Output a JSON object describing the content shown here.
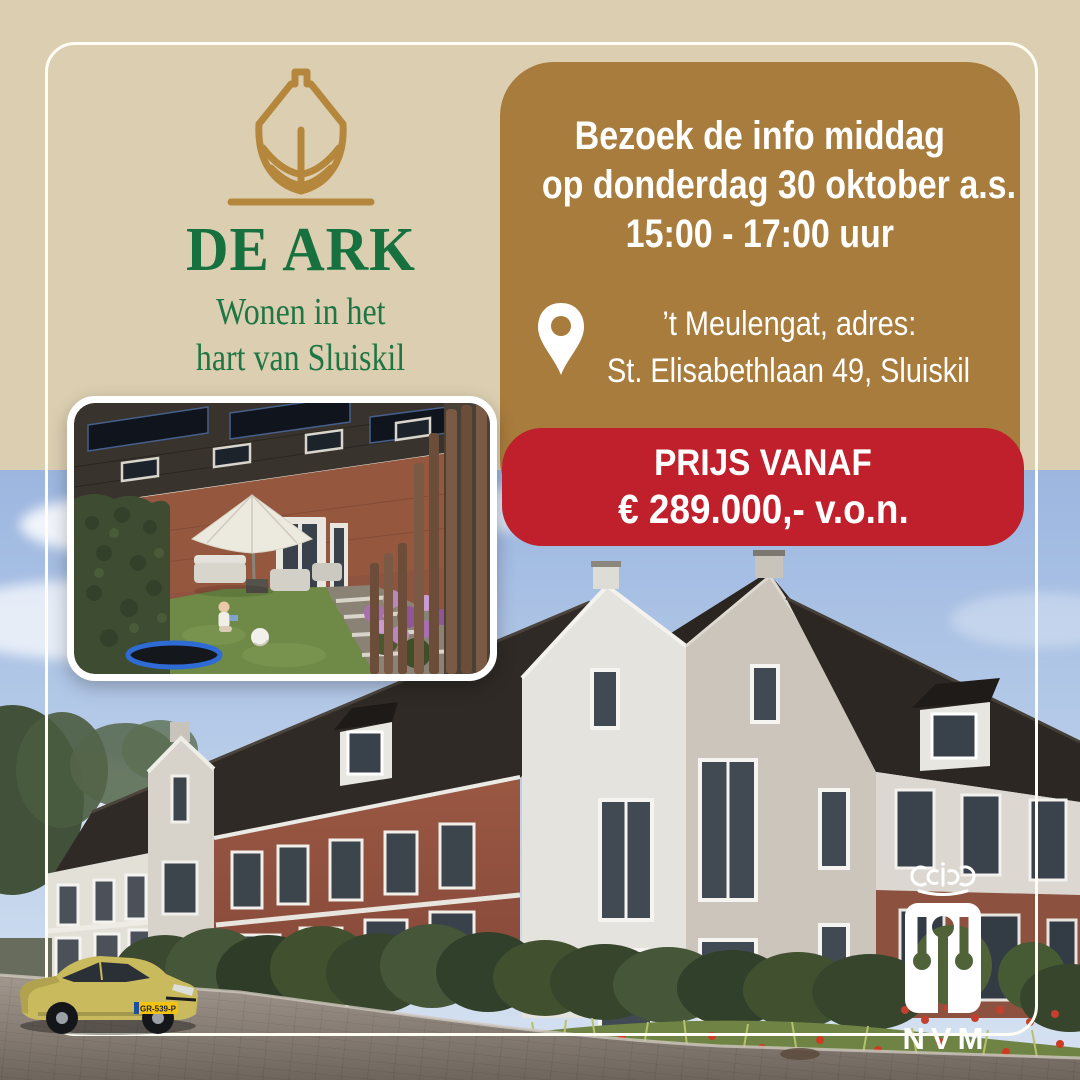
{
  "brand": {
    "title": "DE ARK",
    "tagline_line1": "Wonen in het",
    "tagline_line2": "hart van Sluiskil"
  },
  "info_box": {
    "line1": "Bezoek de info middag",
    "line2": "op donderdag 30 oktober a.s.",
    "line3": "15:00 - 17:00 uur",
    "location_line1": "’t Meulengat, adres:",
    "location_line2": "St. Elisabethlaan 49, Sluiskil"
  },
  "price_box": {
    "label": "PRIJS VANAF",
    "price": "€ 289.000,- v.o.n."
  },
  "nvm_logo": {
    "label": "NVM"
  },
  "car": {
    "license_plate": "GR-539-P"
  },
  "icons": {
    "ark-ship-icon": "gold line drawing of an ark / ship bow",
    "location-pin-icon": "white map pin",
    "nvm-crown-icon": "white stylized crown",
    "nvm-pictogram-icon": "white rounded square with three key figures"
  },
  "colors": {
    "background_beige": "#dccfb1",
    "box_gold": "#a87c3c",
    "box_red": "#bf202b",
    "brand_green": "#17713e",
    "logo_gold": "#b5873c",
    "text_white": "#ffffff"
  }
}
